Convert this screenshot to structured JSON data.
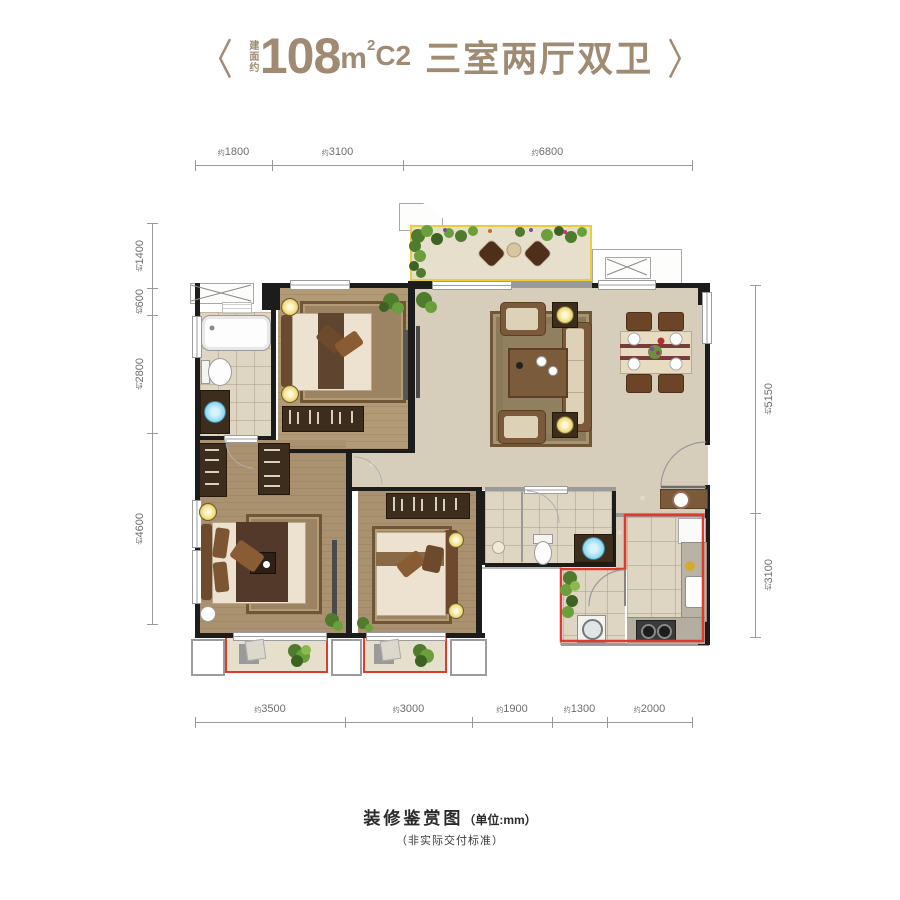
{
  "title": {
    "bracket_left": "〈",
    "bracket_right": "〉",
    "prefix_vertical": "建面约",
    "area": "108",
    "unit_base": "m",
    "unit_sup": "2",
    "type_code": "C2",
    "rooms": "三室两厅双卫"
  },
  "rulers": {
    "prefix": "约",
    "top": [
      "1800",
      "3100",
      "6800"
    ],
    "bottom": [
      "3500",
      "3000",
      "1900",
      "1300",
      "2000"
    ],
    "left": [
      "1400",
      "600",
      "2800",
      "4600"
    ],
    "right": [
      "5150",
      "3100"
    ]
  },
  "caption": {
    "main": "装修鉴赏图",
    "unit_note": "（单位:mm）",
    "subnote": "（非实际交付标准）"
  },
  "colors": {
    "accent_tan": "#a18a72",
    "outline_red": "#e03a2f",
    "outline_yellow": "#e8cf3a",
    "wall_black": "#1c1c1c",
    "wood_floor": "#b29a77",
    "tile_floor": "#ded6c3",
    "living_floor": "#d6cdbb",
    "sand_floor": "#e6dfcc",
    "sink_blue": "#86d7ef",
    "plant_green": "#5d8f3c",
    "lamp_yellow": "#f0dd7a"
  }
}
